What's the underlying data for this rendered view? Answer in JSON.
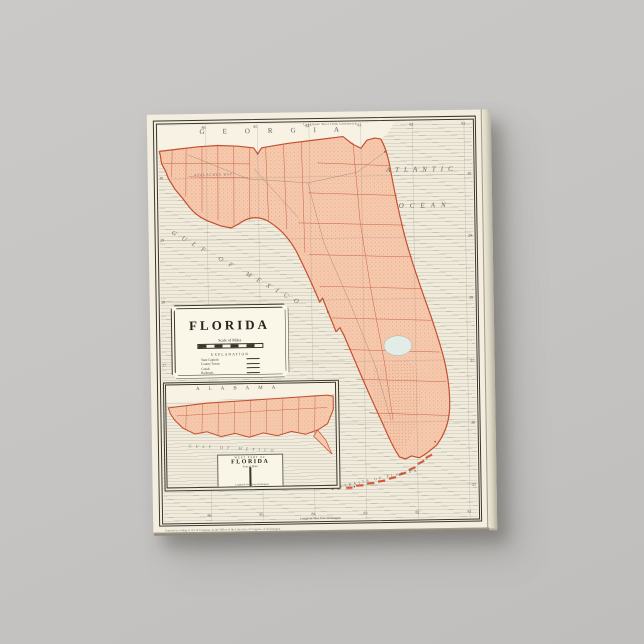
{
  "scene": {
    "product": "Gallery wrapped canvas print of a vintage Florida map",
    "background_color": "#c6c4c2"
  },
  "map": {
    "colors": {
      "paper": "#f2edde",
      "land": "#f6c8ac",
      "boundary_red": "#c44f30",
      "frame_black": "#3b372c"
    },
    "labels": {
      "georgia": "GEORGIA",
      "atlantic": "ATLANTIC",
      "ocean": "OCEAN",
      "gulf_of_mexico": "GULF OF MEXICO",
      "apalachee_bay": "APALACHEE BAY",
      "straits_of_florida": "STRAITS OF FLORIDA"
    },
    "frame": {
      "top_border_label": "Longitude West from Greenwich",
      "bottom_border_label": "Longitude West from Washington",
      "longitude_ticks": [
        "86",
        "85",
        "84",
        "83",
        "82",
        "81"
      ],
      "latitude_ticks": [
        "30",
        "29",
        "28",
        "27",
        "26",
        "25"
      ],
      "copyright": "Entered according to Act of Congress, in the Office of the Librarian of Congress, at Washington."
    },
    "cartouche": {
      "title": "FLORIDA",
      "scale_label": "Scale of Miles",
      "explanation_heading": "EXPLANATION",
      "legend_items": [
        "State Capitals",
        "County Towns",
        "Canals",
        "Railroads"
      ]
    },
    "inset": {
      "alabama": "ALABAMA",
      "gulf_of_mexico": "GULF OF MEXICO",
      "title_top": "WEST PART OF",
      "title": "FLORIDA",
      "scale_label": "Scale of Miles",
      "bottom_border_label": "Longitude West from Washington"
    }
  }
}
